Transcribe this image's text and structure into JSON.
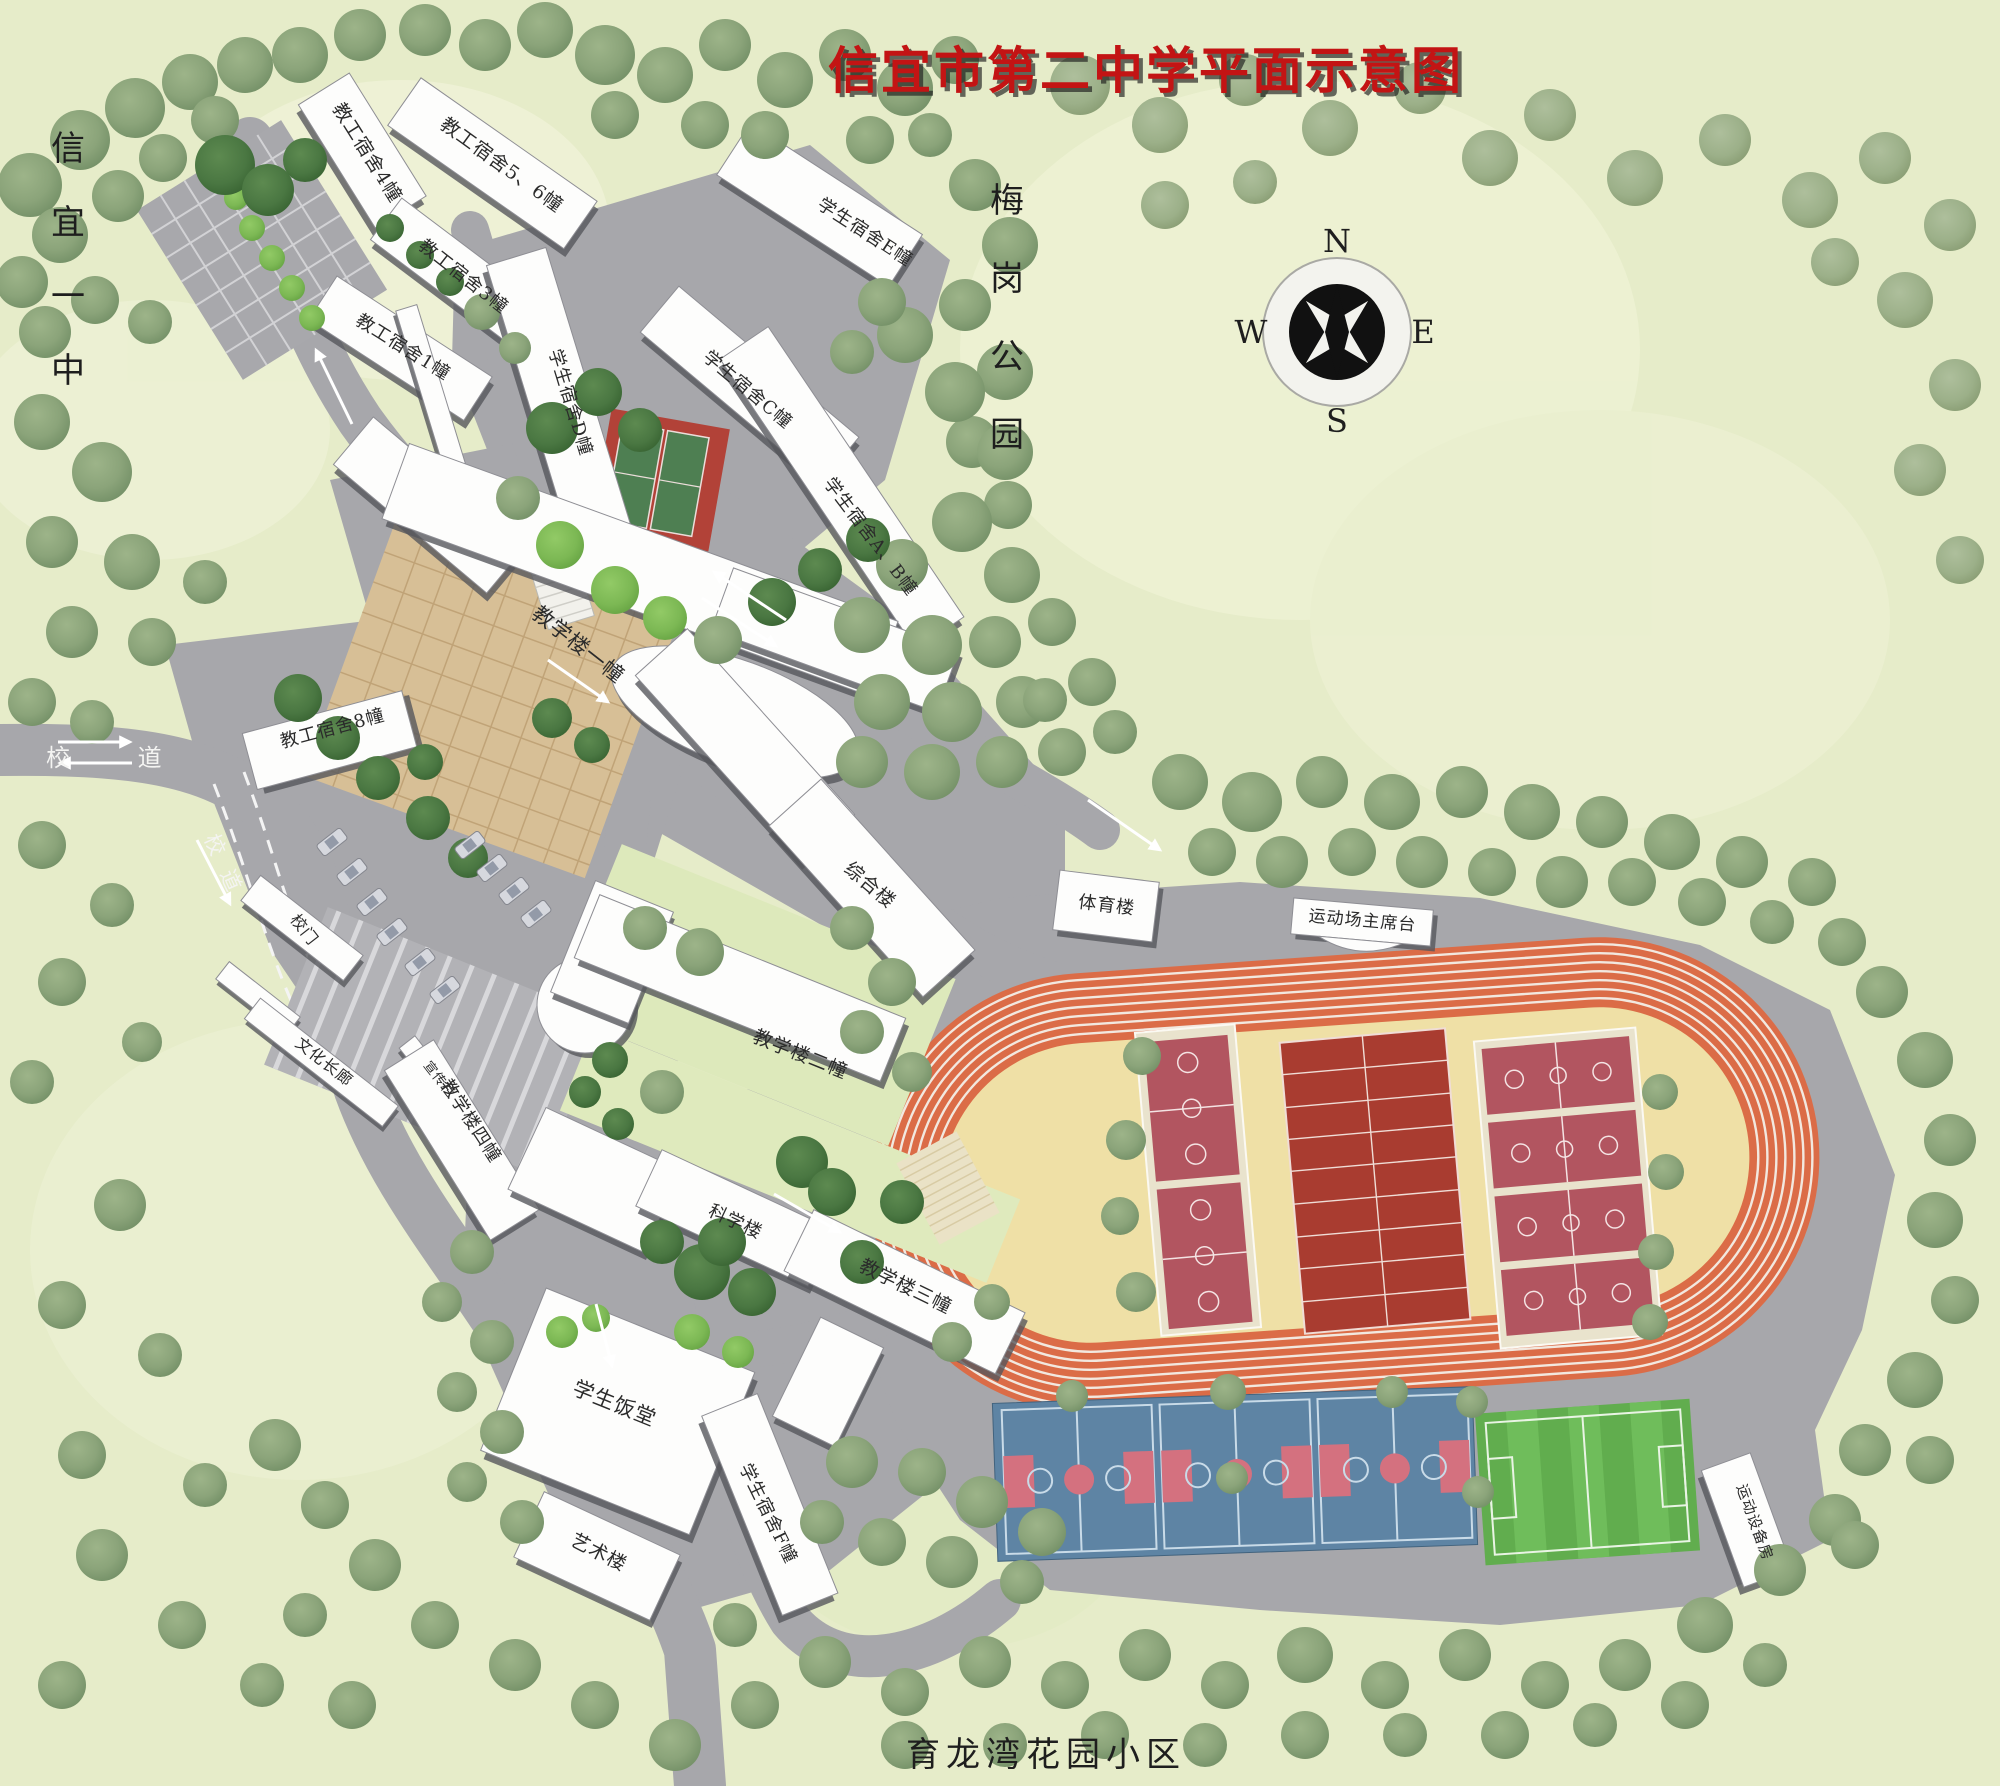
{
  "title": "信宜市第二中学平面示意图",
  "left_label": {
    "chars": [
      "信",
      "宜",
      "一",
      "中"
    ]
  },
  "right_label": {
    "chars": [
      "梅",
      "岗",
      "公",
      "园"
    ]
  },
  "bottom_label": "育龙湾花园小区",
  "compass": {
    "n": "N",
    "e": "E",
    "s": "S",
    "w": "W"
  },
  "roads": {
    "west": "校  道",
    "south": "校道"
  },
  "buildings": {
    "dorm4": "教工宿舍4幢",
    "dorm56": "教工宿舍5、6幢",
    "dorm3": "教工宿舍3幢",
    "dorm1": "教工宿舍1幢",
    "dormD": "学生宿舍D幢",
    "dormE": "学生宿舍E幢",
    "dormC": "学生宿舍C幢",
    "dormAB": "学生宿舍A、B幢",
    "teach1": "教学楼一幢",
    "dorm8": "教工宿舍8幢",
    "complex": "综合楼",
    "sports": "体育楼",
    "stage": "运动场主席台",
    "gate": "校门",
    "corridor": "文化长廊",
    "board": "宣传栏",
    "teach4": "教学楼四幢",
    "teach2": "教学楼二幢",
    "science": "科学楼",
    "teach3": "教学楼三幢",
    "canteen": "学生饭堂",
    "art": "艺术楼",
    "dormF": "学生宿舍F幢",
    "equipment": "运动设备房"
  },
  "colors": {
    "title_red": "#c31414",
    "background_green": "#e6ecc9",
    "road_grey": "#a7a7ab",
    "building_white": "#fdfdfc",
    "track_orange": "#db6c47",
    "infield_cream": "#efe0a6",
    "court_maroon": "#b25560",
    "court_dark_red": "#a93c30",
    "court_blue": "#5e84a4",
    "court_pink": "#d4717f",
    "pitch_green": "#61ad4e",
    "tree_green": "#8fa87e"
  }
}
